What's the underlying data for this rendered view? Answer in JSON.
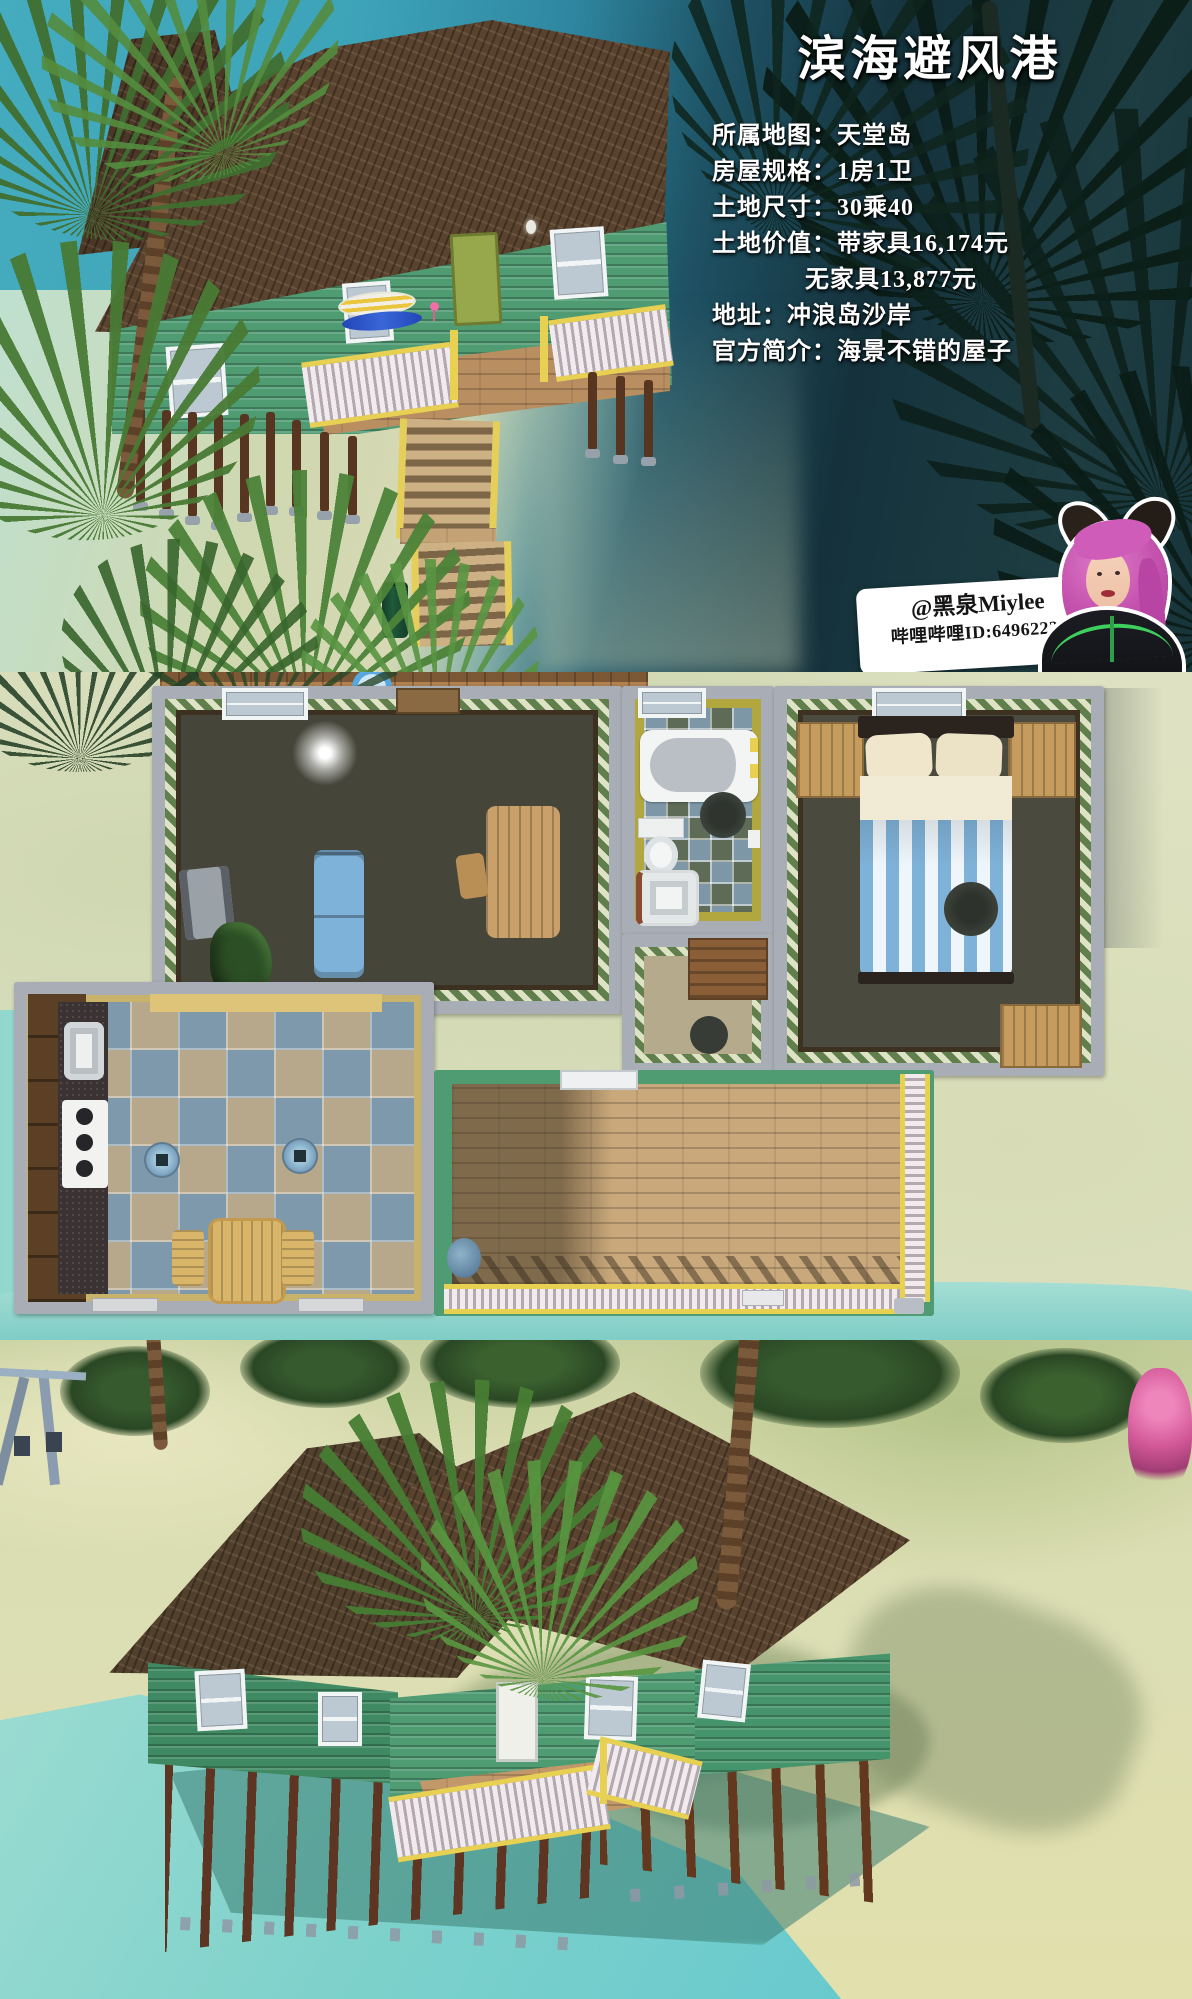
{
  "header": {
    "title": "滨海避风港"
  },
  "info_lines": [
    "所属地图：天堂岛",
    "房屋规格：1房1卫",
    "土地尺寸：30乘40",
    "土地价值：带家具16,174元",
    "无家具13,877元",
    "地址：冲浪岛沙岸",
    "官方简介：海景不错的屋子"
  ],
  "credit": {
    "handle": "@黑泉Miylee",
    "bilibili_id": "哔哩哔哩ID:64962225"
  },
  "colors": {
    "title_text": "#ffffff",
    "info_text": "#ffffff",
    "banner_bg": "#ffffff",
    "banner_text": "#151515",
    "sea_top": "#3fa6bc",
    "sea_deep": "#16333c",
    "sand": "#dfe2c2",
    "shallow_water": "#8fd6cd",
    "roof_brown": "#5a432e",
    "siding_green": "#4f9c73",
    "railing_yellow": "#e8d052",
    "wall_gray": "#a9adb6",
    "floor_olive": "#45453a",
    "tile_blue": "#7e99ab",
    "tile_tan": "#b7a88b",
    "bath_wall_yellow": "#b2a73f",
    "bed_blue": "#7fb2d8",
    "wood": "#c59c5e",
    "avatar_hair_pink": "#c453ae"
  }
}
